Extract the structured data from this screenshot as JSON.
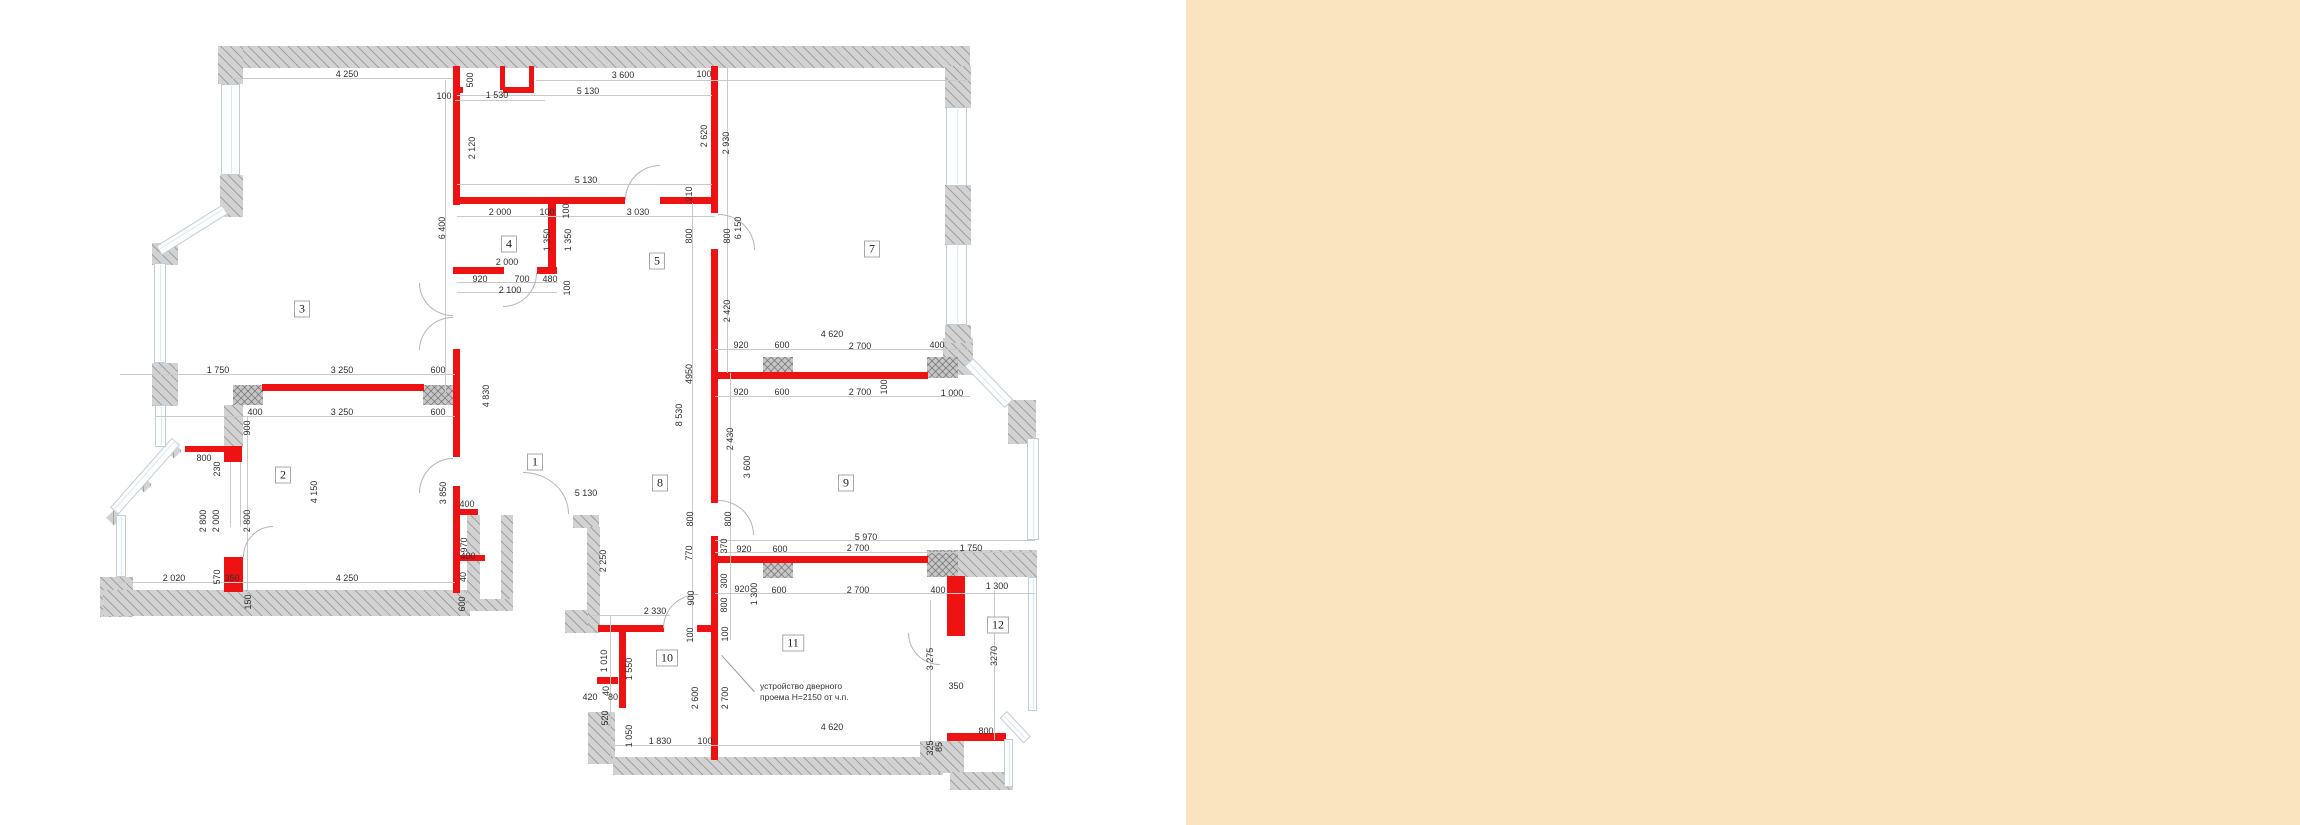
{
  "panel": {
    "color": "#fae4c0",
    "left": 1186
  },
  "colors": {
    "background": "#ffffff",
    "new_wall_red": "#ee1212",
    "existing_wall_gray": "#d2d2d2",
    "dimension_text": "#2f2f2f",
    "dimension_line": "#c9c9c9",
    "window_glass": "#d9e9f3"
  },
  "note": {
    "line1": "устройство дверного",
    "line2": "проема Н=2150 от ч.п.",
    "x": 760,
    "y": 681,
    "leader": {
      "x": 722,
      "y": 655,
      "len": 49,
      "angle": 48
    }
  },
  "rooms": [
    [
      "1",
      535,
      462
    ],
    [
      "2",
      283,
      475
    ],
    [
      "3",
      302,
      309
    ],
    [
      "4",
      509,
      244
    ],
    [
      "5",
      657,
      261
    ],
    [
      "7",
      872,
      249
    ],
    [
      "8",
      660,
      483
    ],
    [
      "9",
      846,
      483
    ],
    [
      "10",
      667,
      658
    ],
    [
      "11",
      793,
      643
    ],
    [
      "12",
      998,
      625
    ]
  ],
  "dims": [
    [
      "4 250",
      347,
      74,
      0
    ],
    [
      "100",
      444,
      96,
      0
    ],
    [
      "500",
      470,
      80,
      1
    ],
    [
      "1 530",
      497,
      95,
      0
    ],
    [
      "3 600",
      623,
      75,
      0
    ],
    [
      "100",
      704,
      74,
      0
    ],
    [
      "5 130",
      588,
      91,
      0
    ],
    [
      "2 120",
      472,
      148,
      1
    ],
    [
      "2 620",
      704,
      136,
      1
    ],
    [
      "2 930",
      726,
      143,
      1
    ],
    [
      "6 400",
      442,
      228,
      1
    ],
    [
      "5 130",
      586,
      180,
      0
    ],
    [
      "210",
      689,
      194,
      1
    ],
    [
      "2 000",
      500,
      212,
      0
    ],
    [
      "100",
      547,
      212,
      0
    ],
    [
      "100",
      566,
      211,
      1
    ],
    [
      "3 030",
      638,
      212,
      0
    ],
    [
      "1 350",
      547,
      240,
      1
    ],
    [
      "1 350",
      568,
      240,
      1
    ],
    [
      "800",
      689,
      236,
      1
    ],
    [
      "800",
      727,
      236,
      1
    ],
    [
      "6 150",
      738,
      228,
      1
    ],
    [
      "2 000",
      507,
      262,
      0
    ],
    [
      "920",
      480,
      279,
      0
    ],
    [
      "700",
      522,
      279,
      0
    ],
    [
      "480",
      550,
      279,
      0
    ],
    [
      "2 100",
      510,
      290,
      0
    ],
    [
      "100",
      567,
      288,
      1
    ],
    [
      "2 420",
      727,
      311,
      1
    ],
    [
      "4 620",
      832,
      334,
      0
    ],
    [
      "920",
      741,
      345,
      0
    ],
    [
      "600",
      782,
      345,
      0
    ],
    [
      "2 700",
      860,
      346,
      0
    ],
    [
      "400",
      937,
      345,
      0
    ],
    [
      "920",
      741,
      392,
      0
    ],
    [
      "600",
      782,
      392,
      0
    ],
    [
      "2 700",
      860,
      392,
      0
    ],
    [
      "100",
      884,
      387,
      1
    ],
    [
      "1 000",
      952,
      393,
      0
    ],
    [
      "4950",
      689,
      374,
      1
    ],
    [
      "8 530",
      679,
      415,
      1
    ],
    [
      "2 430",
      730,
      439,
      1
    ],
    [
      "3 600",
      747,
      467,
      1
    ],
    [
      "800",
      690,
      519,
      1
    ],
    [
      "800",
      728,
      519,
      1
    ],
    [
      "5 970",
      866,
      537,
      0
    ],
    [
      "2 700",
      858,
      548,
      0
    ],
    [
      "1 750",
      971,
      548,
      0
    ],
    [
      "370",
      724,
      546,
      1
    ],
    [
      "920",
      744,
      549,
      0
    ],
    [
      "600",
      780,
      549,
      0
    ],
    [
      "770",
      689,
      553,
      1
    ],
    [
      "920",
      742,
      589,
      0
    ],
    [
      "600",
      779,
      590,
      0
    ],
    [
      "2 700",
      858,
      590,
      0
    ],
    [
      "400",
      938,
      590,
      0
    ],
    [
      "1 300",
      997,
      586,
      0
    ],
    [
      "300",
      724,
      581,
      1
    ],
    [
      "1 300",
      754,
      594,
      1
    ],
    [
      "900",
      691,
      598,
      1
    ],
    [
      "800",
      724,
      605,
      1
    ],
    [
      "100",
      690,
      635,
      1
    ],
    [
      "100",
      725,
      634,
      1
    ],
    [
      "1 750",
      218,
      370,
      0
    ],
    [
      "3 250",
      342,
      370,
      0
    ],
    [
      "600",
      438,
      370,
      0
    ],
    [
      "400",
      255,
      412,
      0
    ],
    [
      "3 250",
      342,
      412,
      0
    ],
    [
      "600",
      438,
      412,
      0
    ],
    [
      "900",
      247,
      428,
      1
    ],
    [
      "800",
      204,
      458,
      0
    ],
    [
      "230",
      217,
      469,
      1
    ],
    [
      "2 800",
      203,
      521,
      1
    ],
    [
      "2 000",
      216,
      521,
      1
    ],
    [
      "2 800",
      247,
      521,
      1
    ],
    [
      "4 150",
      314,
      492,
      1
    ],
    [
      "3 850",
      443,
      493,
      1
    ],
    [
      "400",
      467,
      504,
      0
    ],
    [
      "970",
      464,
      545,
      1
    ],
    [
      "400",
      468,
      556,
      0
    ],
    [
      "40",
      463,
      577,
      1
    ],
    [
      "600",
      462,
      604,
      1
    ],
    [
      "570",
      217,
      577,
      1
    ],
    [
      "350",
      232,
      578,
      0
    ],
    [
      "2 020",
      174,
      578,
      0
    ],
    [
      "4 250",
      347,
      578,
      0
    ],
    [
      "150",
      248,
      602,
      1
    ],
    [
      "4 830",
      486,
      396,
      1
    ],
    [
      "5 130",
      586,
      493,
      0
    ],
    [
      "2 250",
      603,
      561,
      1
    ],
    [
      "2 330",
      655,
      611,
      0
    ],
    [
      "1 010",
      604,
      661,
      1
    ],
    [
      "1 550",
      629,
      669,
      1
    ],
    [
      "2 600",
      695,
      698,
      1
    ],
    [
      "2 700",
      725,
      698,
      1
    ],
    [
      "420",
      590,
      697,
      0
    ],
    [
      "40",
      606,
      691,
      1
    ],
    [
      "80",
      613,
      697,
      0
    ],
    [
      "520",
      605,
      718,
      1
    ],
    [
      "1 050",
      629,
      736,
      1
    ],
    [
      "1 830",
      660,
      741,
      0
    ],
    [
      "100",
      705,
      741,
      0
    ],
    [
      "4 620",
      832,
      727,
      0
    ],
    [
      "3 275",
      930,
      659,
      1
    ],
    [
      "3270",
      994,
      656,
      1
    ],
    [
      "350",
      956,
      686,
      0
    ],
    [
      "800",
      986,
      731,
      0
    ],
    [
      "325",
      930,
      748,
      1
    ],
    [
      "85",
      939,
      747,
      1
    ]
  ],
  "gray_walls": [
    [
      220,
      46,
      750,
      22
    ],
    [
      218,
      46,
      25,
      38
    ],
    [
      220,
      175,
      23,
      42
    ],
    [
      152,
      243,
      26,
      22
    ],
    [
      152,
      363,
      26,
      43
    ],
    [
      224,
      405,
      19,
      42
    ],
    [
      100,
      577,
      33,
      40
    ],
    [
      103,
      590,
      367,
      26
    ],
    [
      467,
      515,
      13,
      96
    ],
    [
      501,
      515,
      12,
      96
    ],
    [
      467,
      599,
      46,
      12
    ],
    [
      573,
      515,
      26,
      13
    ],
    [
      587,
      527,
      13,
      106
    ],
    [
      565,
      610,
      23,
      23
    ],
    [
      588,
      712,
      27,
      52
    ],
    [
      613,
      757,
      330,
      18
    ],
    [
      927,
      550,
      110,
      27
    ],
    [
      943,
      338,
      30,
      37
    ],
    [
      1008,
      400,
      28,
      44
    ],
    [
      945,
      66,
      26,
      42
    ],
    [
      945,
      185,
      26,
      60
    ],
    [
      945,
      325,
      26,
      18
    ],
    [
      920,
      741,
      44,
      32
    ],
    [
      950,
      772,
      63,
      18
    ],
    [
      174,
      443,
      11,
      11,
      45
    ],
    [
      144,
      477,
      11,
      11,
      45
    ],
    [
      114,
      510,
      11,
      11,
      45
    ]
  ],
  "cross_walls": [
    [
      233,
      385,
      30,
      20
    ],
    [
      423,
      385,
      30,
      20
    ],
    [
      763,
      357,
      30,
      21
    ],
    [
      763,
      556,
      30,
      22
    ],
    [
      927,
      357,
      31,
      21
    ],
    [
      927,
      550,
      31,
      27
    ]
  ],
  "red_walls": [
    [
      453,
      66,
      7,
      139
    ],
    [
      453,
      87,
      10,
      6
    ],
    [
      503,
      87,
      31,
      6
    ],
    [
      500,
      66,
      5,
      24
    ],
    [
      529,
      66,
      5,
      26
    ],
    [
      453,
      197,
      172,
      7
    ],
    [
      660,
      197,
      56,
      7
    ],
    [
      548,
      199,
      8,
      74
    ],
    [
      453,
      267,
      51,
      7
    ],
    [
      537,
      267,
      20,
      7
    ],
    [
      453,
      349,
      7,
      108
    ],
    [
      453,
      486,
      7,
      107
    ],
    [
      262,
      384,
      162,
      7
    ],
    [
      185,
      446,
      57,
      6
    ],
    [
      224,
      447,
      18,
      15
    ],
    [
      224,
      557,
      19,
      35
    ],
    [
      459,
      509,
      19,
      6
    ],
    [
      459,
      555,
      26,
      6
    ],
    [
      598,
      625,
      66,
      7
    ],
    [
      697,
      625,
      21,
      7
    ],
    [
      619,
      631,
      7,
      77
    ],
    [
      597,
      677,
      21,
      7
    ],
    [
      711,
      66,
      7,
      147
    ],
    [
      711,
      249,
      7,
      254
    ],
    [
      711,
      536,
      7,
      224
    ],
    [
      711,
      372,
      217,
      7
    ],
    [
      711,
      556,
      217,
      7
    ],
    [
      947,
      576,
      18,
      60
    ],
    [
      947,
      733,
      59,
      8
    ]
  ],
  "windows": [
    [
      221,
      84,
      19,
      91
    ],
    [
      228,
      214,
      78,
      11,
      148
    ],
    [
      154,
      263,
      12,
      100
    ],
    [
      180,
      445,
      93,
      11,
      131.5
    ],
    [
      116,
      515,
      10,
      62
    ],
    [
      155,
      405,
      11,
      42
    ],
    [
      946,
      107,
      21,
      79
    ],
    [
      946,
      244,
      21,
      81
    ],
    [
      973,
      358,
      58,
      12,
      46
    ],
    [
      1027,
      438,
      12,
      102
    ],
    [
      1028,
      577,
      9,
      134
    ],
    [
      1007,
      711,
      35,
      10,
      47
    ],
    [
      1004,
      739,
      9,
      48
    ]
  ],
  "doors": [
    [
      419,
      283,
      34,
      33,
      "bl"
    ],
    [
      419,
      317,
      34,
      33,
      "tl"
    ],
    [
      503,
      273,
      34,
      34,
      "br"
    ],
    [
      625,
      165,
      35,
      35,
      "tl"
    ],
    [
      718,
      214,
      37,
      36,
      "tr"
    ],
    [
      718,
      500,
      36,
      35,
      "tr"
    ],
    [
      419,
      458,
      34,
      35,
      "tl"
    ],
    [
      523,
      472,
      46,
      42,
      "tr"
    ],
    [
      663,
      594,
      35,
      34,
      "tl"
    ],
    [
      908,
      633,
      32,
      32,
      "bl"
    ],
    [
      243,
      526,
      30,
      31,
      "tl"
    ]
  ],
  "dim_lines": [
    [
      230,
      78,
      223,
      1
    ],
    [
      536,
      80,
      434,
      1
    ],
    [
      455,
      100,
      90,
      1
    ],
    [
      457,
      95,
      255,
      1
    ],
    [
      457,
      184,
      255,
      1
    ],
    [
      445,
      80,
      1,
      315
    ],
    [
      457,
      216,
      258,
      1
    ],
    [
      457,
      282,
      100,
      1
    ],
    [
      457,
      292,
      100,
      1
    ],
    [
      692,
      203,
      1,
      437
    ],
    [
      727,
      67,
      1,
      306
    ],
    [
      730,
      373,
      1,
      267
    ],
    [
      715,
      349,
      255,
      1
    ],
    [
      715,
      396,
      255,
      1
    ],
    [
      715,
      540,
      320,
      1
    ],
    [
      715,
      552,
      320,
      1
    ],
    [
      715,
      593,
      320,
      1
    ],
    [
      120,
      374,
      335,
      1
    ],
    [
      155,
      416,
      300,
      1
    ],
    [
      118,
      582,
      337,
      1
    ],
    [
      247,
      416,
      1,
      187
    ],
    [
      613,
      745,
      327,
      1
    ],
    [
      590,
      615,
      80,
      1
    ],
    [
      610,
      615,
      1,
      145
    ],
    [
      994,
      590,
      1,
      150
    ],
    [
      930,
      600,
      1,
      160
    ],
    [
      230,
      462,
      1,
      65
    ],
    [
      240,
      462,
      1,
      65
    ]
  ]
}
